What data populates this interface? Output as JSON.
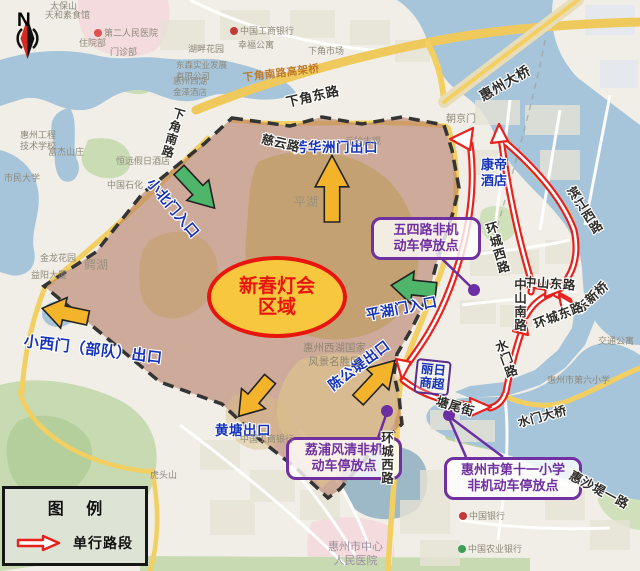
{
  "compass": {
    "n": "N"
  },
  "region": {
    "label": "新春灯会\n区域"
  },
  "gates": {
    "xiaobei": "小北门入口",
    "fanghuazhou": "芳华洲门出口",
    "xiaoxi": "小西门（部队）出口",
    "huangtang": "黄塘出口",
    "pinghu": "平湖门入口",
    "chengongdi": "陈公堤出口"
  },
  "parking": {
    "wusi": "五四路非机\n动车停放点",
    "lipu": "荔浦风清非机\n动车停放点",
    "shiyi": "惠州市第十一小学\n非机动车停放点"
  },
  "landmarks": {
    "kangdi": "康帝\n酒店",
    "liri": "丽日\n商超"
  },
  "roads": {
    "xiajiaodong": "下角东路",
    "xiajiaonan": "下角南路",
    "gaojiaqiao": "下角南路高架桥",
    "ciyun": "慈云路",
    "huanchengxi_n": "环城西路",
    "huanchengxi_s": "环城西路",
    "zhongshandong": "中山东路",
    "zhongshannan": "中山南路",
    "dongxinqiao": "东新桥",
    "huanchengdong": "环城东路",
    "shuimenlu": "水门路",
    "binjiangxi": "滨江西路",
    "tangweijie": "塘尾街",
    "huizhoudaqiao": "惠州大桥",
    "shuimendaqiao": "水门大桥",
    "huishadiyilu": "惠沙堤一路"
  },
  "areas": {
    "pinghu": "平湖",
    "ehu": "鳄湖",
    "xihu": "惠州西湖国家\n风景名胜区",
    "zhongxinyiyuan": "惠州市中心\n人民医院"
  },
  "poi": {
    "taibaoshan": "太保山",
    "tianhe": "天和素食馆",
    "dieryiyuan": "第二人民医院",
    "zhuyuanbu": "住院部",
    "menzhenbu": "门诊部",
    "gongshang": "中国工商银行",
    "xingfu": "幸福公寓",
    "hupan": "湖畔花园",
    "xiajiaoshichang": "下角市场",
    "dongsen": "东森实业发展\n有限公司",
    "jinze": "惠州西湖\n金泽酒店",
    "gongchengxuexiao": "惠州工程\n技术学校",
    "fujie": "富杰山庄",
    "hengyuan": "恒远假日酒店",
    "shimindaxue": "市民大学",
    "shihua": "中国石化",
    "jinlong": "金龙花园",
    "yiyang": "益阳大厦",
    "chaojingmen": "朝京门",
    "yuanmiao": "元妙古观",
    "diliuxiaoxue": "惠州市第六小学",
    "jiaotong": "交通公寓",
    "zhongguoyinhang": "中国银行",
    "nongyeyinhang": "中国农业银行",
    "hutoushan": "虎头山",
    "gongshang2": "中国工商银行",
    "dongxinqiao_poi": "东新桥"
  },
  "legend": {
    "title": "图 例",
    "one_way": "单行路段"
  },
  "colors": {
    "one_way_red": "#e8211d",
    "entrance_green": "#4eb56b",
    "exit_yellow": "#f3b32b",
    "parking_purple": "#7030a0",
    "gate_blue": "#1633b8",
    "region_border_red": "#e8150f",
    "region_fill_yellow": "#f7c83d",
    "water_blue": "#a7c5da"
  }
}
